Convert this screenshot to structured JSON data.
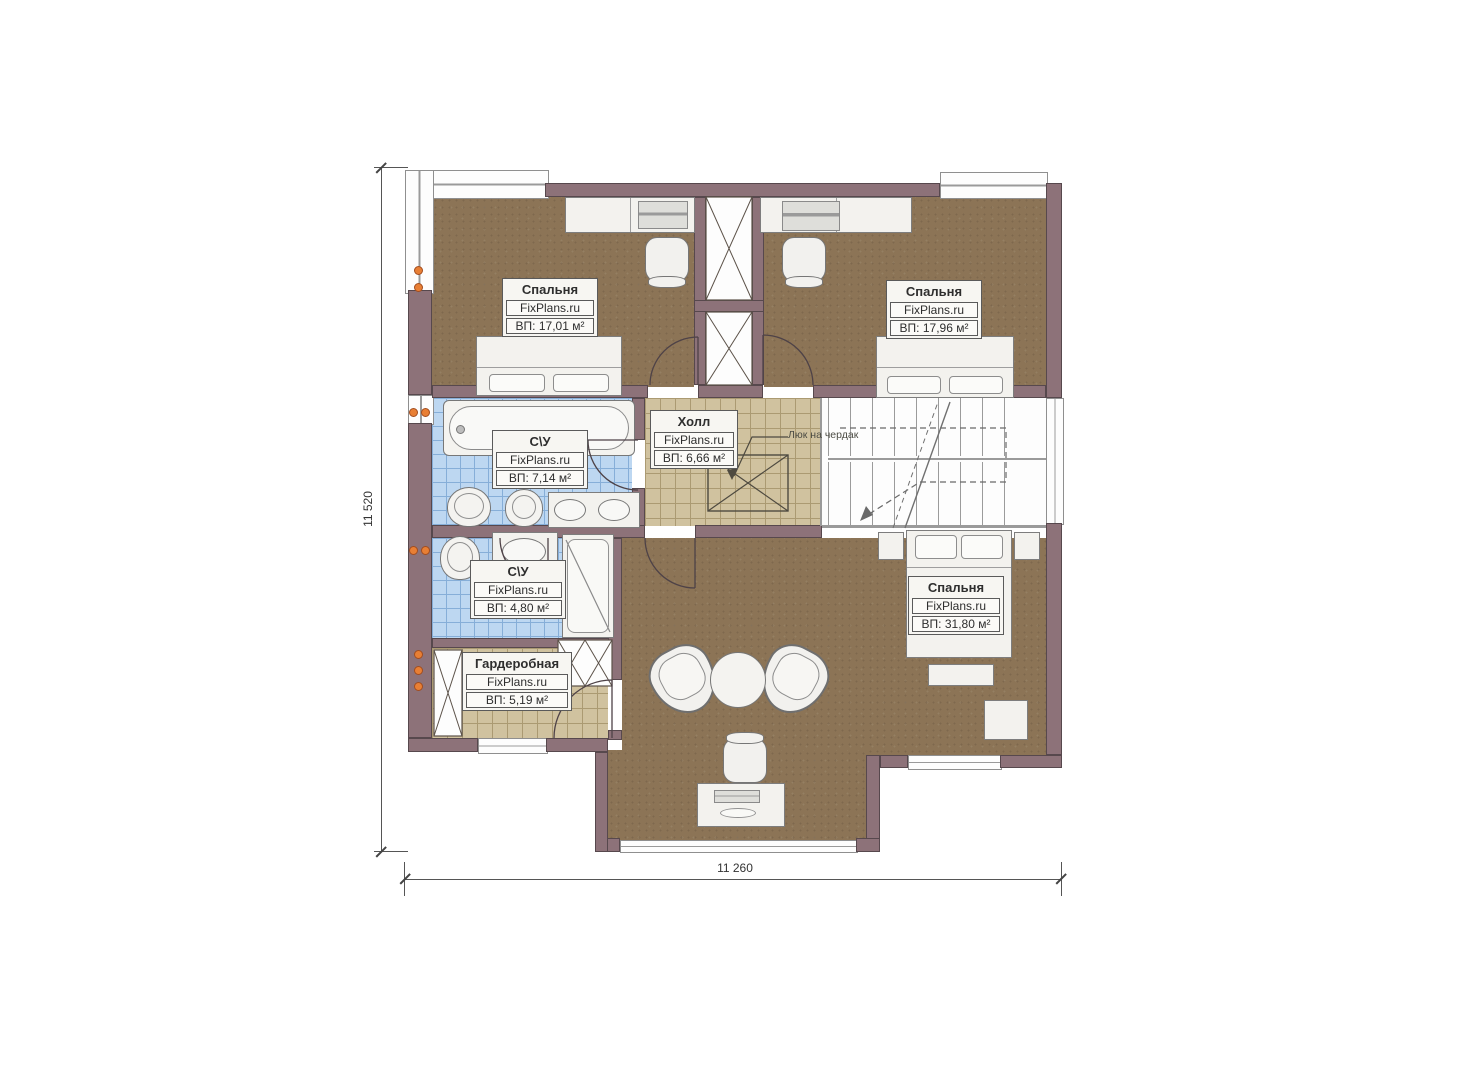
{
  "plan": {
    "brand": "FixPlans.ru",
    "dimension_width": "11 260",
    "dimension_height": "11 520",
    "attic_note": "Люк на чердак",
    "rooms": {
      "bedroom1": {
        "name": "Спальня",
        "brand": "FixPlans.ru",
        "area": "ВП: 17,01 м²"
      },
      "bedroom2": {
        "name": "Спальня",
        "brand": "FixPlans.ru",
        "area": "ВП: 17,96 м²"
      },
      "hall": {
        "name": "Холл",
        "brand": "FixPlans.ru",
        "area": "ВП: 6,66 м²"
      },
      "bath1": {
        "name": "С\\У",
        "brand": "FixPlans.ru",
        "area": "ВП: 7,14 м²"
      },
      "bath2": {
        "name": "С\\У",
        "brand": "FixPlans.ru",
        "area": "ВП: 4,80 м²"
      },
      "wardrobe": {
        "name": "Гардеробная",
        "brand": "FixPlans.ru",
        "area": "ВП: 5,19 м²"
      },
      "bedroom3": {
        "name": "Спальня",
        "brand": "FixPlans.ru",
        "area": "ВП: 31,80 м²"
      }
    },
    "colors": {
      "wall": "#8d7279",
      "floor_bedroom": "#8c7456",
      "floor_tile_blue": "#bdd7f1",
      "floor_tile_tan": "#d0c29f",
      "socket_accent": "#e87f35"
    }
  }
}
